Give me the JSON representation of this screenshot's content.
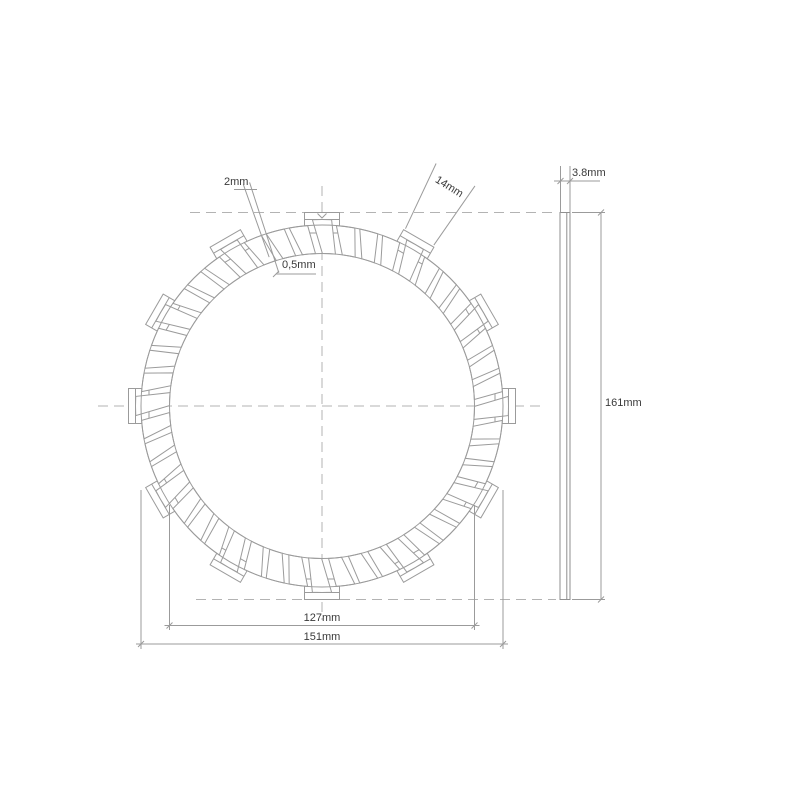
{
  "drawing": {
    "type": "technical-drawing",
    "subject": "clutch-friction-plate-front-and-side-view"
  },
  "labels": {
    "groove_width": "2mm",
    "pad_tab_width": "14mm",
    "step_depth": "0,5mm",
    "friction_inner_diameter": "127mm",
    "friction_outer_diameter": "151mm",
    "plate_thickness": "3.8mm",
    "overall_diameter": "161mm"
  },
  "colors": {
    "line": "#9b9b9b",
    "side_line": "#8f8f8f",
    "dash": "#b3b3b3",
    "text": "#3a3a3a",
    "background": "#ffffff"
  },
  "geometry": {
    "center_x": 322,
    "center_y": 406,
    "pad_outer_radius": 181,
    "pad_inner_radius": 152.5,
    "tab_outer_radius": 193.5,
    "tab_inner_radius": 173,
    "tab_chord_radius": 186.5,
    "tab_half_width_px": 17.5,
    "pad_count": 48,
    "tab_every": 4,
    "tab_start_deg": 90,
    "pad_step_deg": 7.5,
    "pad_outer_half_deg": 2.95,
    "pad_inner_half_deg": 2.45,
    "pad_shear_deg": 2.6,
    "dim_127": {
      "ext_x1": 169.5,
      "ext_x2": 474.5,
      "line_y": 625.5,
      "ext_top": 505,
      "ext_bot": 630
    },
    "dim_151": {
      "ext_x1": 141,
      "ext_x2": 503,
      "line_y": 644,
      "ext_top": 490,
      "ext_bot": 649
    },
    "dim_2mm": {
      "angle_a": 107.95,
      "angle_b": 109.55,
      "r1a": 140,
      "r1b": 158,
      "r2": 235,
      "leader_y": 189.5,
      "leader_x1": 234,
      "leader_x2": 257
    },
    "dim_05mm": {
      "underline_x1": 276,
      "underline_x2": 316,
      "underline_y": 274
    },
    "dim_14mm": {
      "angle_a": 64.8,
      "angle_b": 55.2,
      "r1": 196,
      "r2": 268
    },
    "side_view": {
      "left": 560,
      "right": 570,
      "top": 212.5,
      "bottom": 599.5,
      "liner_x": 566.8,
      "dim_line_x": 601,
      "ext_right": 605,
      "thk_ext_top": 166,
      "thk_line_y": 181,
      "thk_line_x1": 554,
      "thk_line_x2": 600
    },
    "centerlines": {
      "h_y": 406,
      "h_x1": 98,
      "h_x2": 546,
      "v_x": 322,
      "v_y1": 186,
      "v_y2": 620,
      "top_y": 212.5,
      "top_x1": 190,
      "top_x2": 556,
      "bot_y": 599.5,
      "bot_x1": 196,
      "bot_x2": 556
    }
  }
}
